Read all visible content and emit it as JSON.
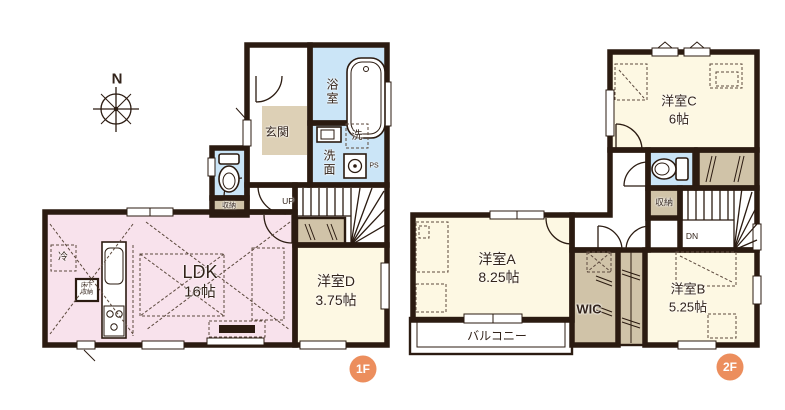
{
  "colors": {
    "wall": "#2b1b11",
    "pink": "#f8e2ec",
    "cream": "#fdf8e3",
    "blue": "#cbe5f7",
    "tan": "#d0c3a8",
    "tan2": "#ddd0b6",
    "badge": "#ec8e5d"
  },
  "compass": {
    "north_label": "N"
  },
  "floor1": {
    "badge": "1F",
    "ldk": {
      "name": "LDK",
      "area": "16帖"
    },
    "room_d": {
      "name": "洋室D",
      "area": "3.75帖"
    },
    "genkan": {
      "label": "玄関"
    },
    "bathroom": {
      "label": "浴室"
    },
    "washroom": {
      "label": "洗面"
    },
    "washer": {
      "label": "洗"
    },
    "pipe_space": {
      "label": "PS"
    },
    "stairs": {
      "label": "UP"
    },
    "toilet_storage": {
      "label": "収納"
    },
    "underfloor_storage": {
      "label": "床下収納"
    },
    "fridge": {
      "label": "冷"
    }
  },
  "floor2": {
    "badge": "2F",
    "room_a": {
      "name": "洋室A",
      "area": "8.25帖"
    },
    "room_b": {
      "name": "洋室B",
      "area": "5.25帖"
    },
    "room_c": {
      "name": "洋室C",
      "area": "6帖"
    },
    "wic": {
      "label": "WIC"
    },
    "storage": {
      "label": "収納"
    },
    "balcony": {
      "label": "バルコニー"
    },
    "stairs": {
      "label": "DN"
    }
  }
}
